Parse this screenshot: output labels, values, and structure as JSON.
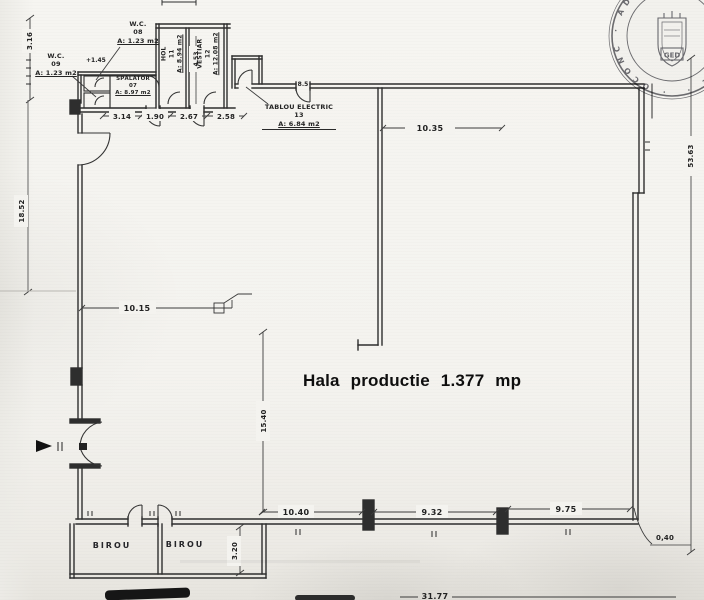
{
  "hall": {
    "label": "Hala productie 1.377 mp"
  },
  "rooms": {
    "wc08": {
      "name": "W.C.",
      "number": "08",
      "area": "A: 1.23 m2"
    },
    "wc09": {
      "name": "W.C.",
      "number": "09",
      "area": "A: 1.23 m2"
    },
    "spalator": {
      "name": "SPĂLĂTOR",
      "number": "07",
      "area": "A: 8.97 m2"
    },
    "hol": {
      "name": "HOL",
      "number": "11",
      "area": "A: 8.94 m2"
    },
    "vestiar": {
      "name": "VESTIAR",
      "number": "12",
      "area": "A: 12.08 m2"
    },
    "tablou": {
      "name": "TABLOU ELECTRIC",
      "number": "13",
      "area": "A: 6.84 m2"
    },
    "birou_left": {
      "name": "BIROU"
    },
    "birou_right": {
      "name": "BIROU"
    }
  },
  "levels": {
    "annex": "+1.45"
  },
  "dims": {
    "left_top": "3.16",
    "left_mid": "18.52",
    "annex_widths": [
      "3.14",
      "1.90",
      "2.67",
      "2.58"
    ],
    "annex_height": "4.53",
    "door_top": "8.5",
    "top_span": "10.35",
    "right_span": "53.63",
    "right_offset": "0,40",
    "inner_width": "10.15",
    "inner_height": "15.40",
    "bottom_spans": [
      "10.40",
      "9.32",
      "9.75"
    ],
    "birou_depth": "3.20",
    "overall_width": "31.77"
  },
  "stamp": {
    "ring_text": "· OCONC · ADMINISTRAT · FUTLCE ·",
    "center_text": "GED"
  }
}
